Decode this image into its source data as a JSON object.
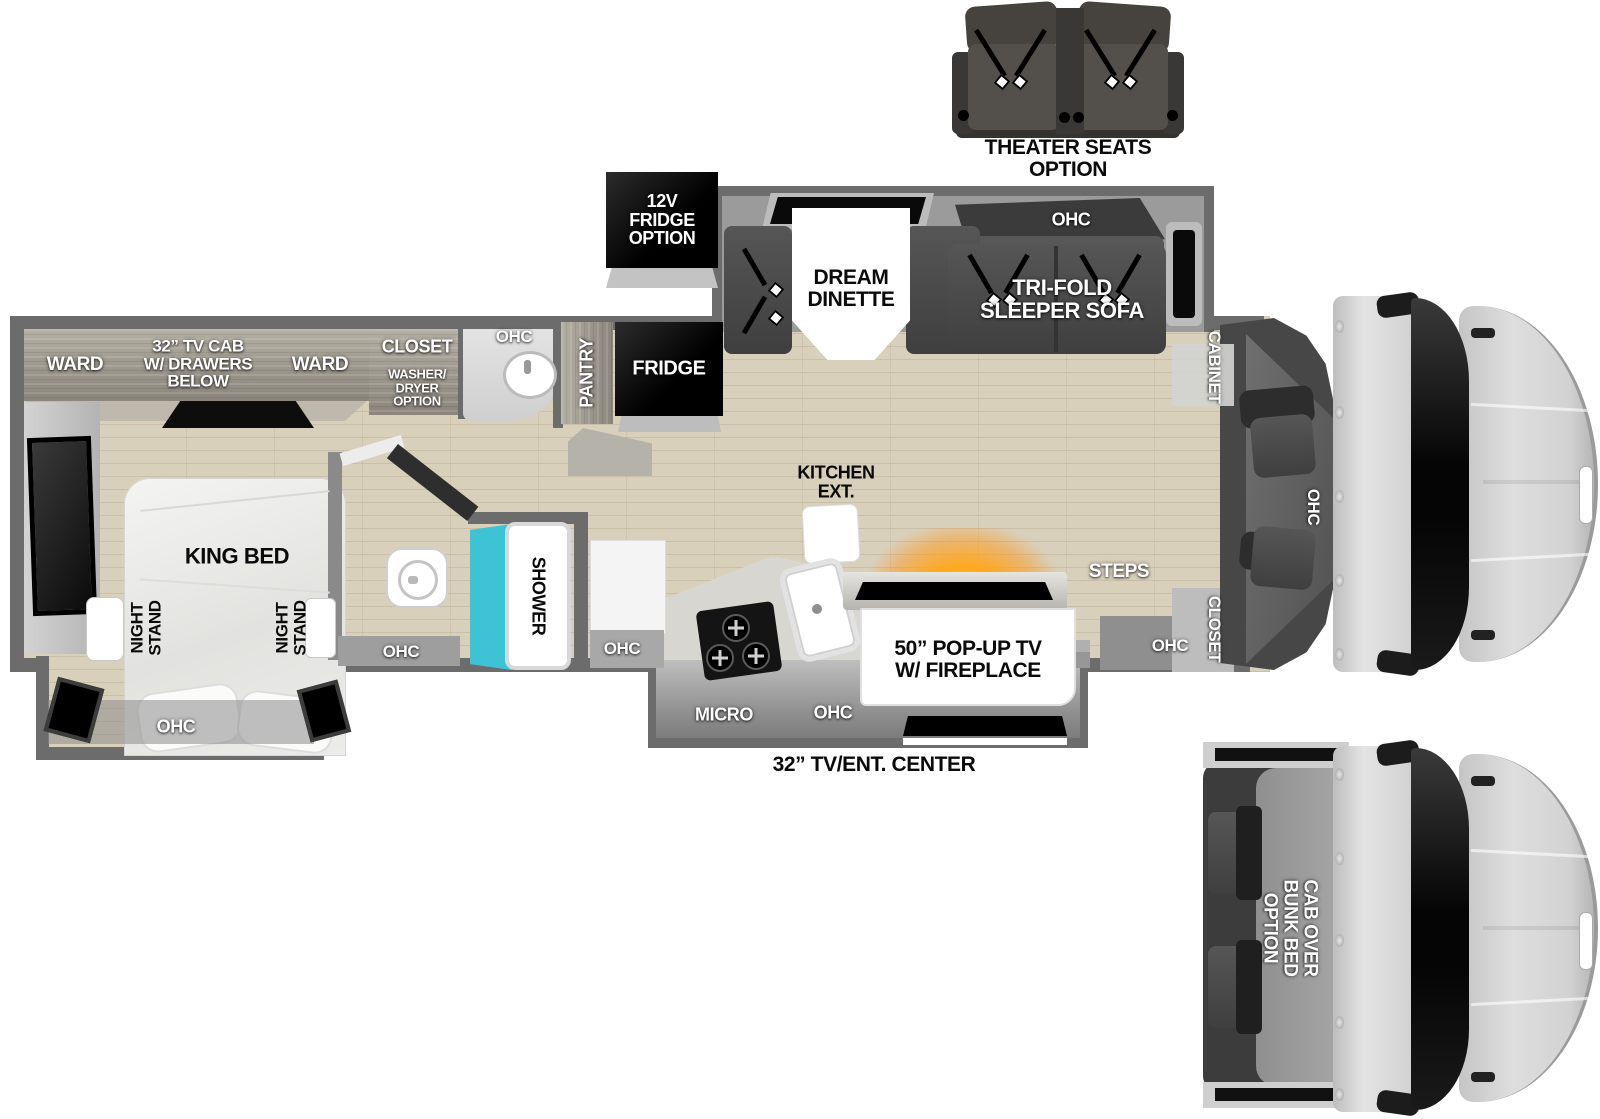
{
  "colors": {
    "floor": "#d9d0bb",
    "wall": "#6c6c6c",
    "shower_teal": "#3ec3d4",
    "fireplace_glow": "#ffb43c",
    "cab_body": "#d6d6d6",
    "appliance_black": "#0a0a0a"
  },
  "floorplan": {
    "options_top": {
      "theater_seats": "THEATER SEATS\nOPTION",
      "fridge_12v": "12V\nFRIDGE\nOPTION"
    },
    "bedroom": {
      "ward_left": "WARD",
      "tv_cab": "32” TV CAB\nW/ DRAWERS\nBELOW",
      "ward_right": "WARD",
      "closet": "CLOSET",
      "washer_dryer": "WASHER/\nDRYER\nOPTION",
      "king_bed": "KING BED",
      "night_stand_left": "NIGHT\nSTAND",
      "night_stand_right": "NIGHT\nSTAND",
      "ohc": "OHC"
    },
    "bath": {
      "vanity_ohc": "OHC",
      "shower": "SHOWER",
      "ohc_left": "OHC",
      "ohc_right": "OHC"
    },
    "kitchen": {
      "pantry": "PANTRY",
      "fridge": "FRIDGE",
      "kitchen_ext": "KITCHEN\nEXT.",
      "micro": "MICRO",
      "ohc": "OHC",
      "island_tv": "50” POP-UP TV\nW/ FIREPLACE",
      "tv_ent_center": "32” TV/ENT. CENTER"
    },
    "living": {
      "dinette": "DREAM\nDINETTE",
      "sofa": "TRI-FOLD\nSLEEPER SOFA",
      "sofa_ohc": "OHC",
      "steps": "STEPS",
      "entry_ohc": "OHC",
      "entry_closet": "CLOSET",
      "cabinet": "CABINET",
      "cab_ohc": "OHC"
    },
    "cab_option": {
      "bunk": "CAB OVER\nBUNK BED\nOPTION"
    }
  }
}
